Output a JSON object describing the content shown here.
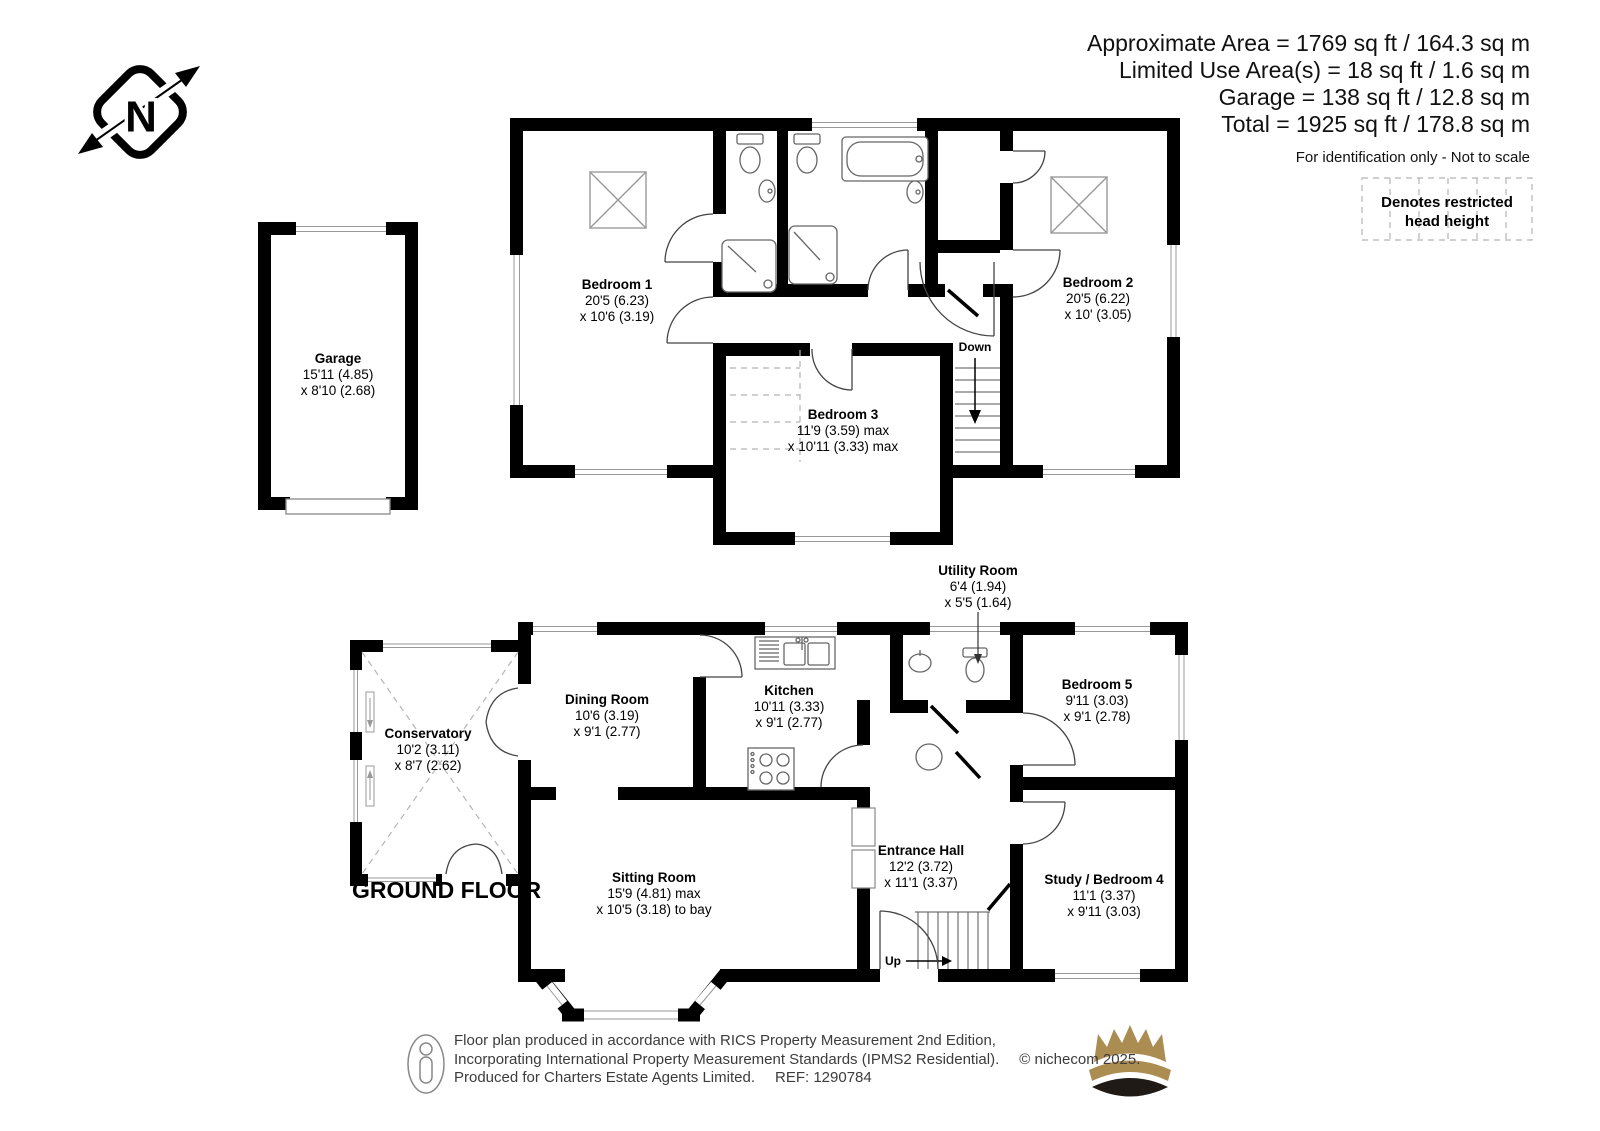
{
  "header": {
    "area_lines": [
      "Approximate Area = 1769 sq ft / 164.3 sq m",
      "Limited Use Area(s) = 18 sq ft / 1.6 sq m",
      "Garage = 138 sq ft / 12.8 sq m",
      "Total = 1925 sq ft / 178.8 sq m"
    ],
    "disclaimer": "For identification only - Not to scale"
  },
  "legend": {
    "line1": "Denotes restricted",
    "line2": "head height"
  },
  "compass": {
    "north_label": "N"
  },
  "first_floor": {
    "bedroom1": {
      "name": "Bedroom 1",
      "dim1": "20'5 (6.23)",
      "dim2": "x 10'6 (3.19)"
    },
    "bedroom2": {
      "name": "Bedroom 2",
      "dim1": "20'5 (6.22)",
      "dim2": "x 10' (3.05)"
    },
    "bedroom3": {
      "name": "Bedroom 3",
      "dim1": "11'9 (3.59) max",
      "dim2": "x 10'11 (3.33) max"
    },
    "stairs_label": "Down"
  },
  "garage": {
    "name": "Garage",
    "dim1": "15'11 (4.85)",
    "dim2": "x 8'10 (2.68)"
  },
  "ground_floor": {
    "label": "GROUND FLOOR",
    "conservatory": {
      "name": "Conservatory",
      "dim1": "10'2 (3.11)",
      "dim2": "x 8'7 (2.62)"
    },
    "dining_room": {
      "name": "Dining Room",
      "dim1": "10'6 (3.19)",
      "dim2": "x 9'1 (2.77)"
    },
    "kitchen": {
      "name": "Kitchen",
      "dim1": "10'11 (3.33)",
      "dim2": "x 9'1 (2.77)"
    },
    "utility_room": {
      "name": "Utility Room",
      "dim1": "6'4 (1.94)",
      "dim2": "x 5'5 (1.64)"
    },
    "bedroom5": {
      "name": "Bedroom 5",
      "dim1": "9'11 (3.03)",
      "dim2": "x 9'1 (2.78)"
    },
    "sitting_room": {
      "name": "Sitting Room",
      "dim1": "15'9 (4.81) max",
      "dim2": "x 10'5 (3.18) to bay"
    },
    "entrance_hall": {
      "name": "Entrance Hall",
      "dim1": "12'2 (3.72)",
      "dim2": "x 11'1 (3.37)"
    },
    "study_bedroom4": {
      "name": "Study / Bedroom 4",
      "dim1": "11'1 (3.37)",
      "dim2": "x 9'11 (3.03)"
    },
    "stairs_label": "Up"
  },
  "footer": {
    "line1": "Floor plan produced in accordance with RICS Property Measurement 2nd Edition,",
    "line2": "Incorporating International Property Measurement Standards (IPMS2 Residential).",
    "copyright": "© nichecom 2025.",
    "line3": "Produced for Charters Estate Agents Limited.",
    "ref": "REF: 1290784"
  },
  "colors": {
    "wall": "#000000",
    "fixture_stroke": "#666666",
    "window_frame": "#999999",
    "dashed_gray": "#b5b5b5",
    "crown_gold": "#ab8d52",
    "crown_dark": "#1f1a16",
    "footer_text": "#3c3c3c"
  }
}
